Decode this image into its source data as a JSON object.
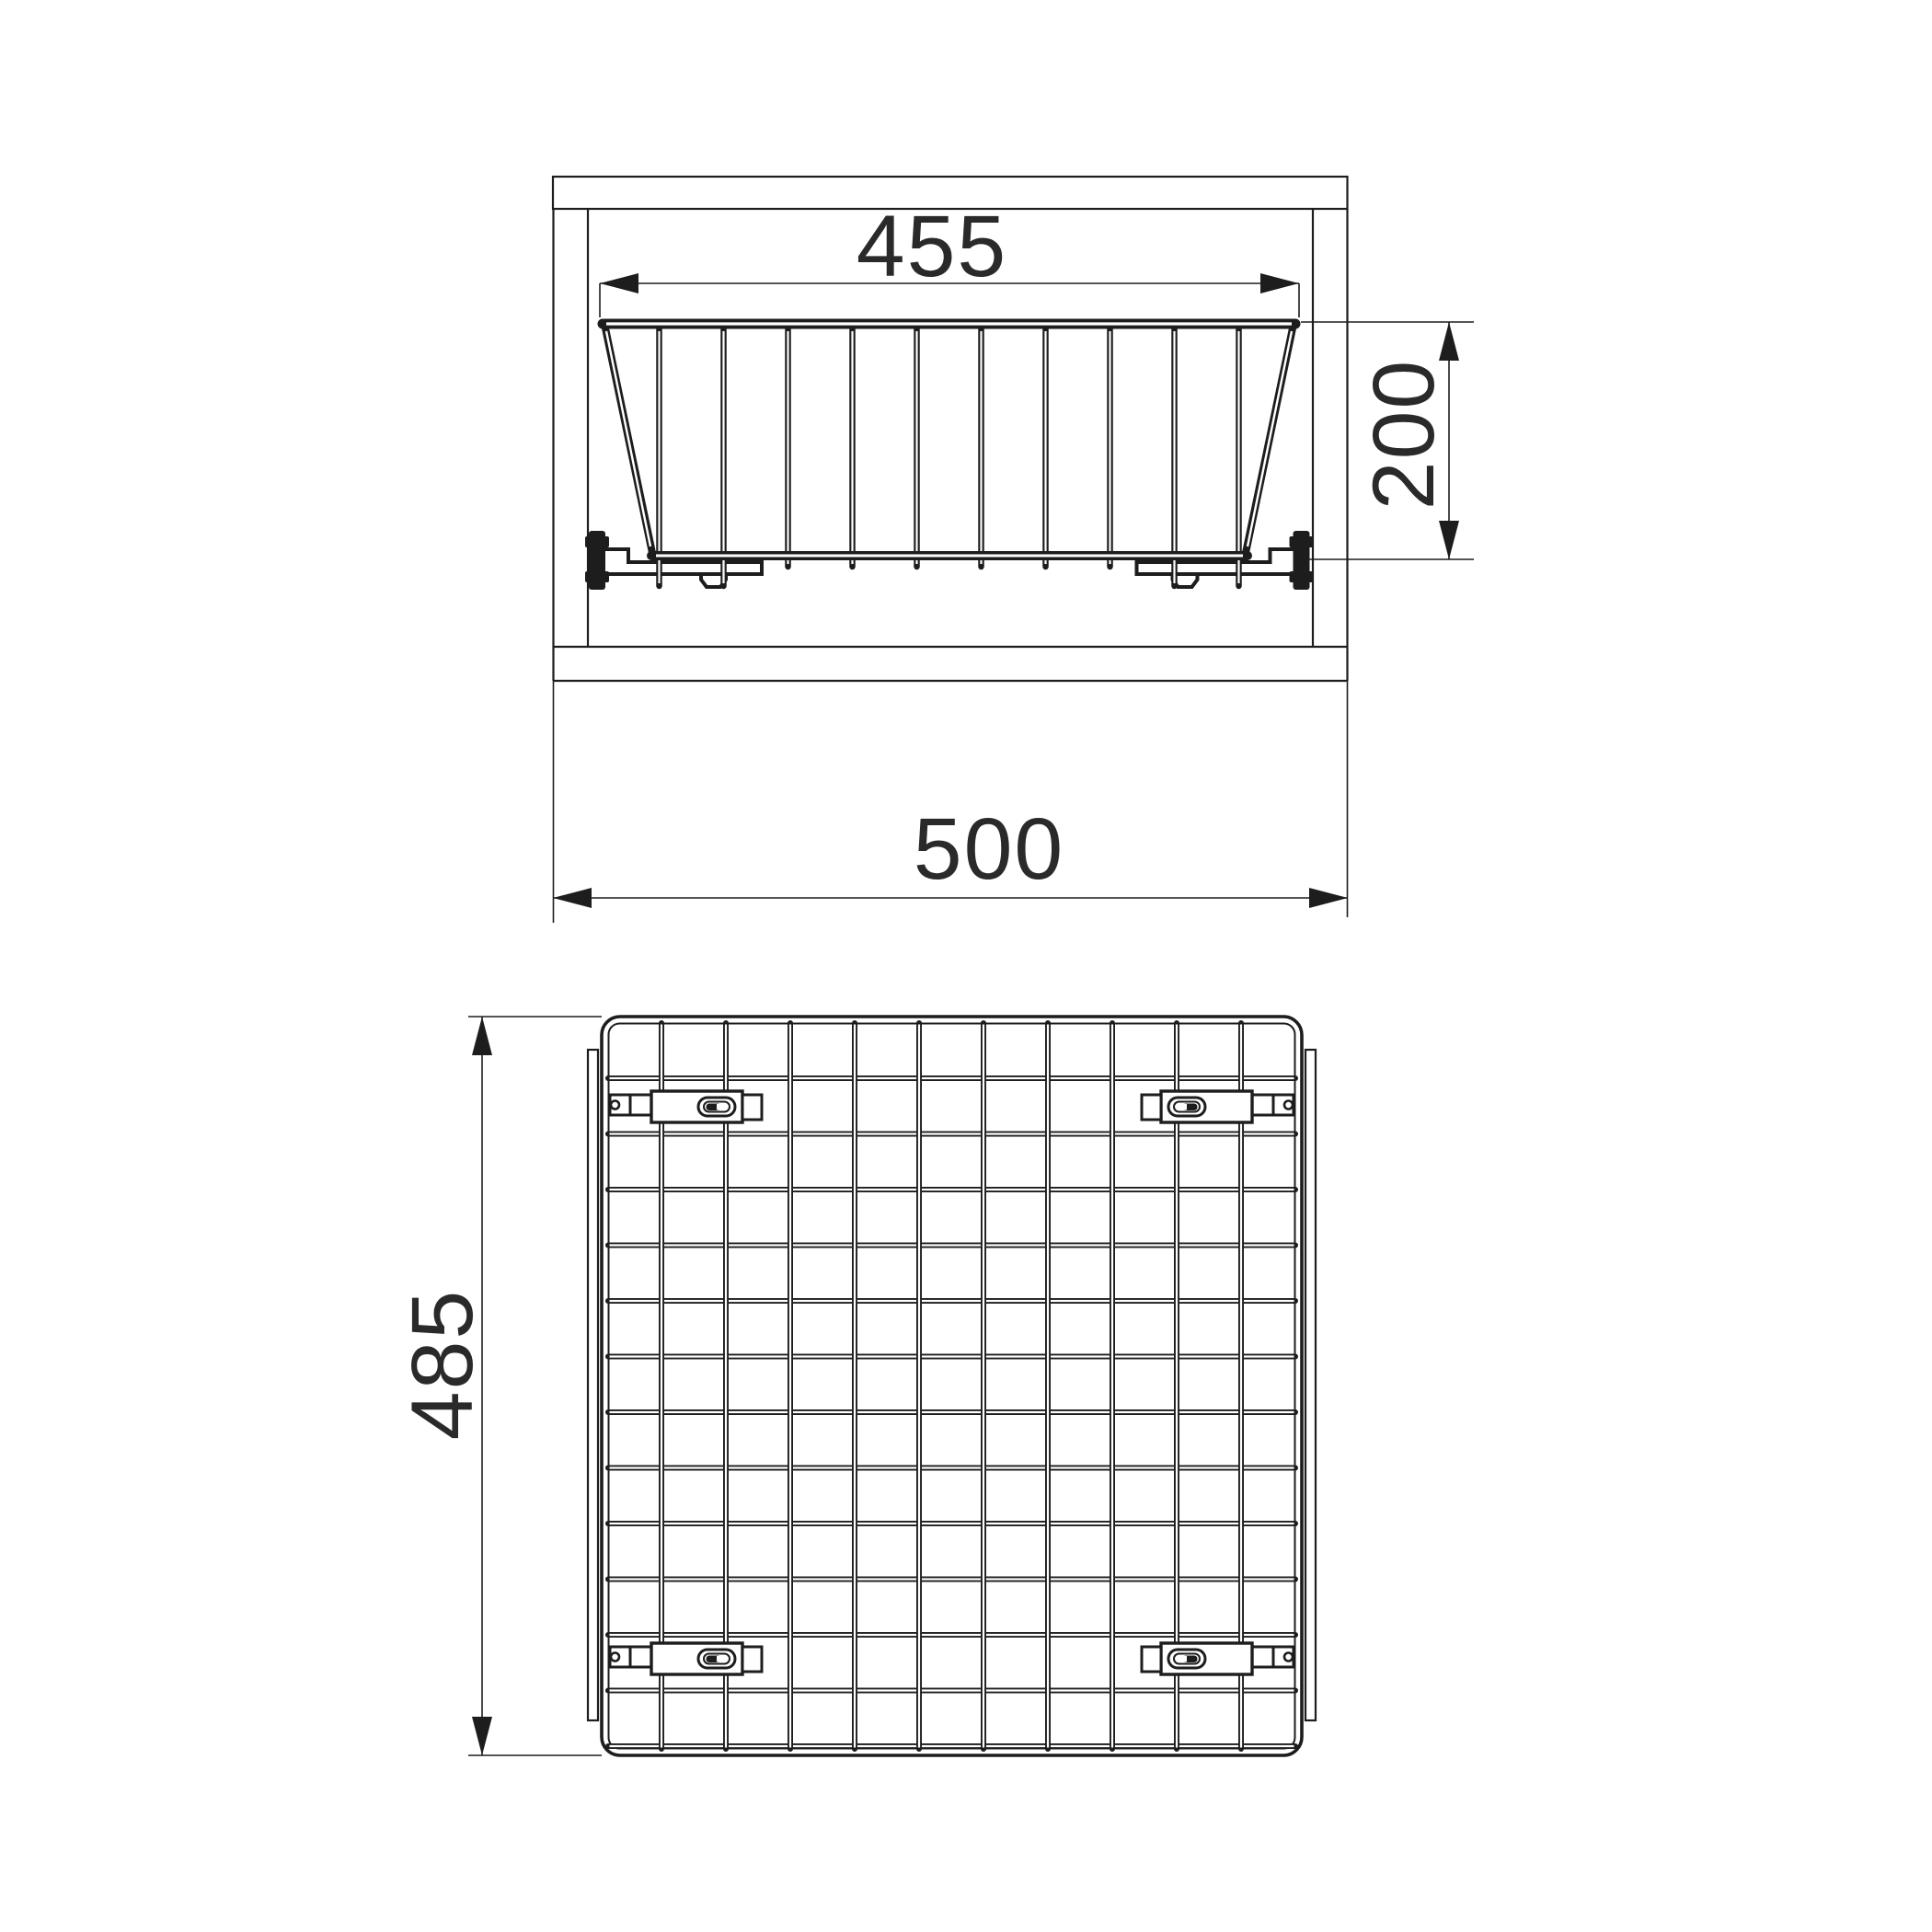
{
  "drawing": {
    "kind": "technical-dimensional-drawing",
    "subject": "pull-out wire basket mounted inside cabinet",
    "line_color": "#1d1d1d",
    "text_color": "#2a2a2a",
    "background_color": "#ffffff",
    "front_view": {
      "name": "front elevation - basket inside cabinet",
      "dim_basket_top_width": {
        "label": "455"
      },
      "dim_basket_height": {
        "label": "200"
      },
      "dim_cabinet_width": {
        "label": "500"
      }
    },
    "plan_view": {
      "name": "top view - wire mesh basket",
      "dim_basket_depth": {
        "label": "485"
      }
    },
    "mesh": {
      "front_vertical_wire_count": 10,
      "plan_vertical_wire_count": 10,
      "plan_horizontal_wire_count": 13,
      "slide_bracket_count": 4
    }
  }
}
